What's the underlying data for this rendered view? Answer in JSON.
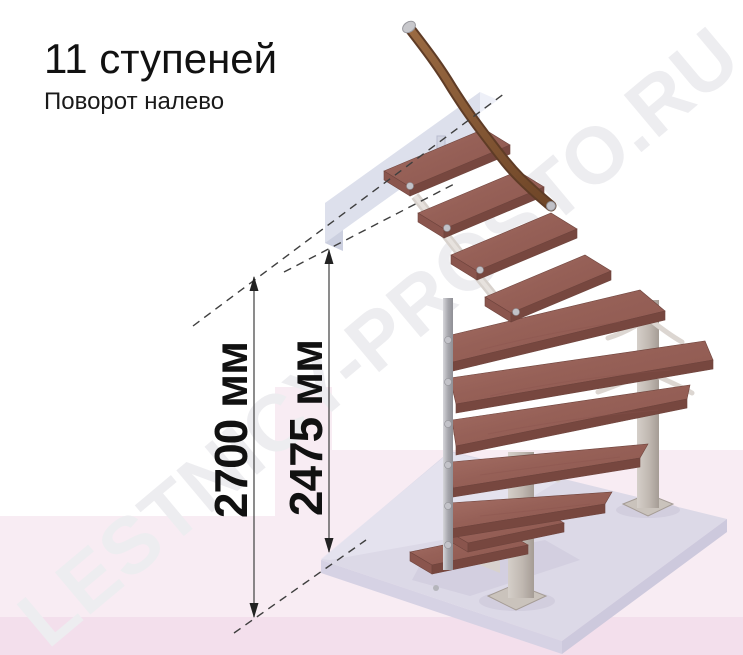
{
  "page": {
    "title": "11 ступеней",
    "subtitle": "Поворот налево"
  },
  "watermark": {
    "text": "LESTNICY-PROSTO.RU"
  },
  "dimensions": {
    "total": {
      "label": "2700 мм"
    },
    "flight": {
      "label": "2475 мм"
    }
  },
  "stair": {
    "steps_count": "11",
    "turn_direction": "налево",
    "straight_steps_top": 4,
    "winder_steps": 5,
    "straight_steps_bottom": 2
  },
  "colors": {
    "background": "#ffffff",
    "pink_zone": "#f8ecf3",
    "pink_strip": "#f3dfec",
    "watermark": "#ededf0",
    "tread_top": "#9c655c",
    "tread_front": "#77473f",
    "handrail": "#8a5a38",
    "metal": "#c0c0c6",
    "column": "#c6beb8",
    "landing_beam": "#dde0ec",
    "floor_slab": "#dcd9e7",
    "dimension_line": "#4d4d4d",
    "text": "#111111"
  }
}
